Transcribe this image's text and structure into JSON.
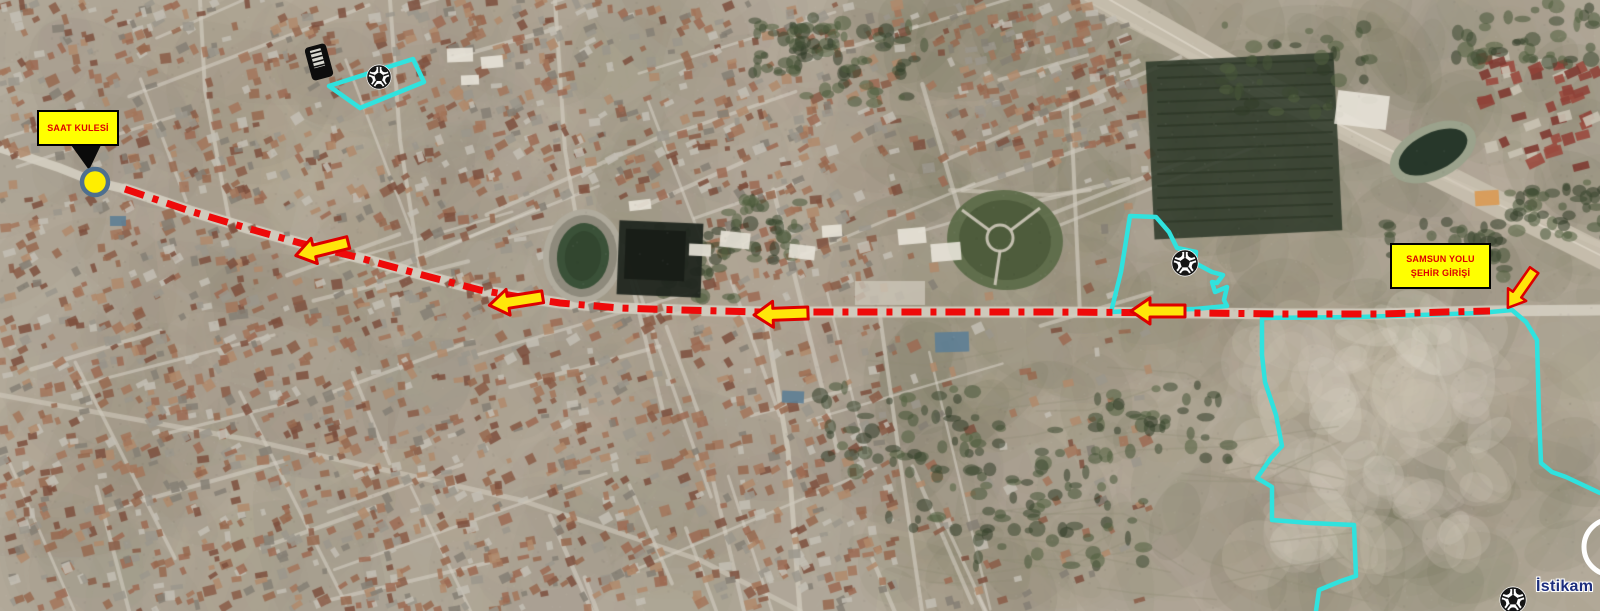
{
  "canvas": {
    "width": 1600,
    "height": 611
  },
  "labels": {
    "saat_kulesi": {
      "text": "SAAT KULESİ",
      "x": 37,
      "y": 110,
      "w": 82,
      "h": 36
    },
    "samsun": {
      "line1": "SAMSUN YOLU",
      "line2": "ŞEHİR GİRİŞİ",
      "x": 1390,
      "y": 243,
      "w": 101,
      "h": 46
    },
    "istikamet": {
      "text": "İstikam",
      "x": 1536,
      "y": 578
    }
  },
  "colors": {
    "route": "#ee0a0a",
    "arrow_fill": "#ffe60a",
    "arrow_stroke": "#dd0000",
    "boundary": "#30e2de",
    "label_bg": "#ffff00",
    "label_text": "#dd0000",
    "marker_fill": "#ffee00",
    "marker_stroke": "#4e6f8e",
    "istikamet_text": "#1c2d7c"
  },
  "route": {
    "width": 7,
    "dash": "20 9 6 9",
    "points": [
      [
        125,
        189
      ],
      [
        190,
        211
      ],
      [
        250,
        229
      ],
      [
        300,
        243
      ],
      [
        360,
        258
      ],
      [
        430,
        277
      ],
      [
        480,
        290
      ],
      [
        520,
        297
      ],
      [
        560,
        303
      ],
      [
        620,
        308
      ],
      [
        680,
        310
      ],
      [
        760,
        312
      ],
      [
        900,
        312
      ],
      [
        1050,
        312
      ],
      [
        1200,
        313
      ],
      [
        1285,
        314
      ],
      [
        1380,
        314
      ],
      [
        1445,
        312
      ],
      [
        1490,
        311
      ]
    ]
  },
  "arrows": [
    {
      "name": "route-arrow-1",
      "x": 322,
      "y": 249,
      "rot": -14,
      "s": 1
    },
    {
      "name": "route-arrow-2",
      "x": 516,
      "y": 301,
      "rot": -9,
      "s": 1
    },
    {
      "name": "route-arrow-3",
      "x": 781,
      "y": 314,
      "rot": -2,
      "s": 1
    },
    {
      "name": "route-arrow-4",
      "x": 1158,
      "y": 311,
      "rot": 0,
      "s": 1
    },
    {
      "name": "city-entry-arrow",
      "x": 1521,
      "y": 289,
      "rot": -55,
      "s": 0.85
    }
  ],
  "marker": {
    "x": 95,
    "y": 182,
    "r": 13
  },
  "pointer": [
    [
      71,
      145
    ],
    [
      101,
      145
    ],
    [
      89,
      170
    ]
  ],
  "boundaries": [
    {
      "name": "stadium-area",
      "closed": true,
      "points": [
        [
          329,
          86
        ],
        [
          413,
          59
        ],
        [
          424,
          82
        ],
        [
          360,
          108
        ]
      ]
    },
    {
      "name": "facility-area",
      "closed": true,
      "points": [
        [
          1130,
          216
        ],
        [
          1156,
          217
        ],
        [
          1169,
          232
        ],
        [
          1177,
          248
        ],
        [
          1196,
          252
        ],
        [
          1195,
          263
        ],
        [
          1212,
          272
        ],
        [
          1223,
          275
        ],
        [
          1217,
          283
        ],
        [
          1212,
          282
        ],
        [
          1215,
          292
        ],
        [
          1227,
          287
        ],
        [
          1224,
          300
        ],
        [
          1227,
          306
        ],
        [
          1195,
          309
        ],
        [
          1130,
          311
        ],
        [
          1111,
          312
        ],
        [
          1121,
          272
        ]
      ]
    },
    {
      "name": "east-district",
      "closed": false,
      "points": [
        [
          1600,
          493
        ],
        [
          1566,
          477
        ],
        [
          1552,
          472
        ],
        [
          1541,
          463
        ],
        [
          1539,
          415
        ],
        [
          1537,
          340
        ],
        [
          1526,
          322
        ],
        [
          1512,
          310
        ],
        [
          1480,
          313
        ],
        [
          1360,
          317
        ],
        [
          1262,
          318
        ],
        [
          1262,
          355
        ],
        [
          1265,
          382
        ],
        [
          1276,
          415
        ],
        [
          1282,
          446
        ],
        [
          1271,
          458
        ],
        [
          1257,
          478
        ],
        [
          1272,
          487
        ],
        [
          1272,
          520
        ],
        [
          1310,
          523
        ],
        [
          1354,
          525
        ],
        [
          1356,
          576
        ],
        [
          1341,
          581
        ],
        [
          1319,
          590
        ],
        [
          1316,
          611
        ]
      ]
    }
  ],
  "balls": [
    {
      "x": 379,
      "y": 77,
      "r": 11
    },
    {
      "x": 1185,
      "y": 263,
      "r": 12
    },
    {
      "x": 1513,
      "y": 600,
      "r": 12
    }
  ],
  "grandstand": {
    "x": 319,
    "y": 62,
    "rot": -15
  },
  "partial_circle": {
    "x": 1612,
    "y": 547,
    "r": 28
  }
}
